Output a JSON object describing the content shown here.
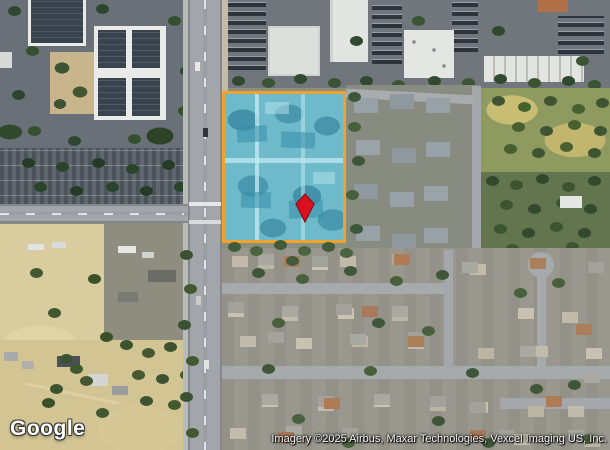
{
  "map": {
    "watermark": "Google",
    "attribution": "Imagery ©2025 Airbus, Maxar Technologies, Vexcel Imaging US, Inc.",
    "overlay": {
      "parcel_border_color": "#f0a32c",
      "parcel_fill_color": "#6fbaca",
      "marker_color": "#da1020"
    }
  }
}
